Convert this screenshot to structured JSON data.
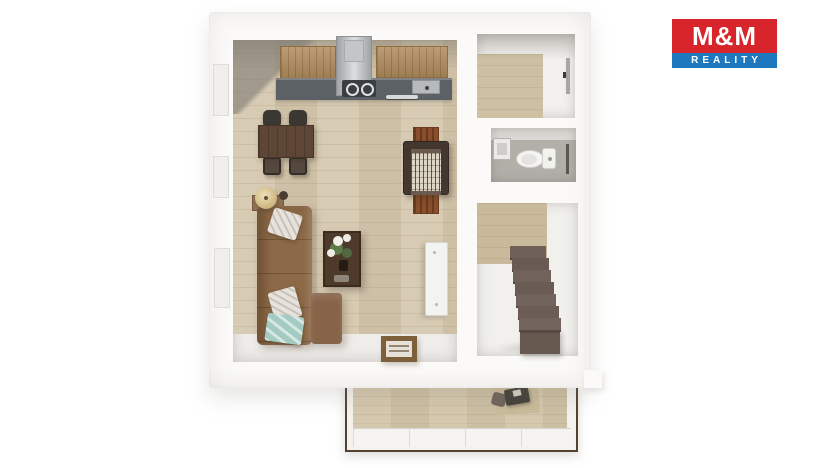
{
  "logo": {
    "title": "M&M",
    "subtitle": "REALITY",
    "title_bg": "#d8242b",
    "subtitle_bg": "#1d78bd",
    "text_color": "#ffffff"
  },
  "palette": {
    "slab": "#fbfaf8",
    "wood_floor": "#d5c7ad",
    "hall_wood": "#cdc0a3",
    "stair_wood": "#c9ba9c",
    "balcony_wood": "#d2c5a9",
    "counter": "#5c6165",
    "cabinet_wood": "#b08b5c",
    "sofa": "#8c6947",
    "dining_table": "#5d4635",
    "coffee_table": "#4e3a2a",
    "wc_floor": "#b2afa9",
    "accent_pillow": "#a4cbc1",
    "balcony_trim": "#55422e",
    "firewood": "#8a4e2b"
  },
  "steps": [
    {
      "left": 33,
      "top": 43,
      "width": 36,
      "height": 12,
      "color": "#6f6159"
    },
    {
      "left": 35,
      "top": 55,
      "width": 37,
      "height": 12,
      "color": "#695b53"
    },
    {
      "left": 36,
      "top": 67,
      "width": 38,
      "height": 12,
      "color": "#71635b"
    },
    {
      "left": 38,
      "top": 79,
      "width": 39,
      "height": 12,
      "color": "#6a5c54"
    },
    {
      "left": 39,
      "top": 91,
      "width": 40,
      "height": 12,
      "color": "#72645c"
    },
    {
      "left": 41,
      "top": 103,
      "width": 41,
      "height": 12,
      "color": "#6b5d55"
    },
    {
      "left": 42,
      "top": 115,
      "width": 42,
      "height": 12,
      "color": "#73655d"
    }
  ]
}
